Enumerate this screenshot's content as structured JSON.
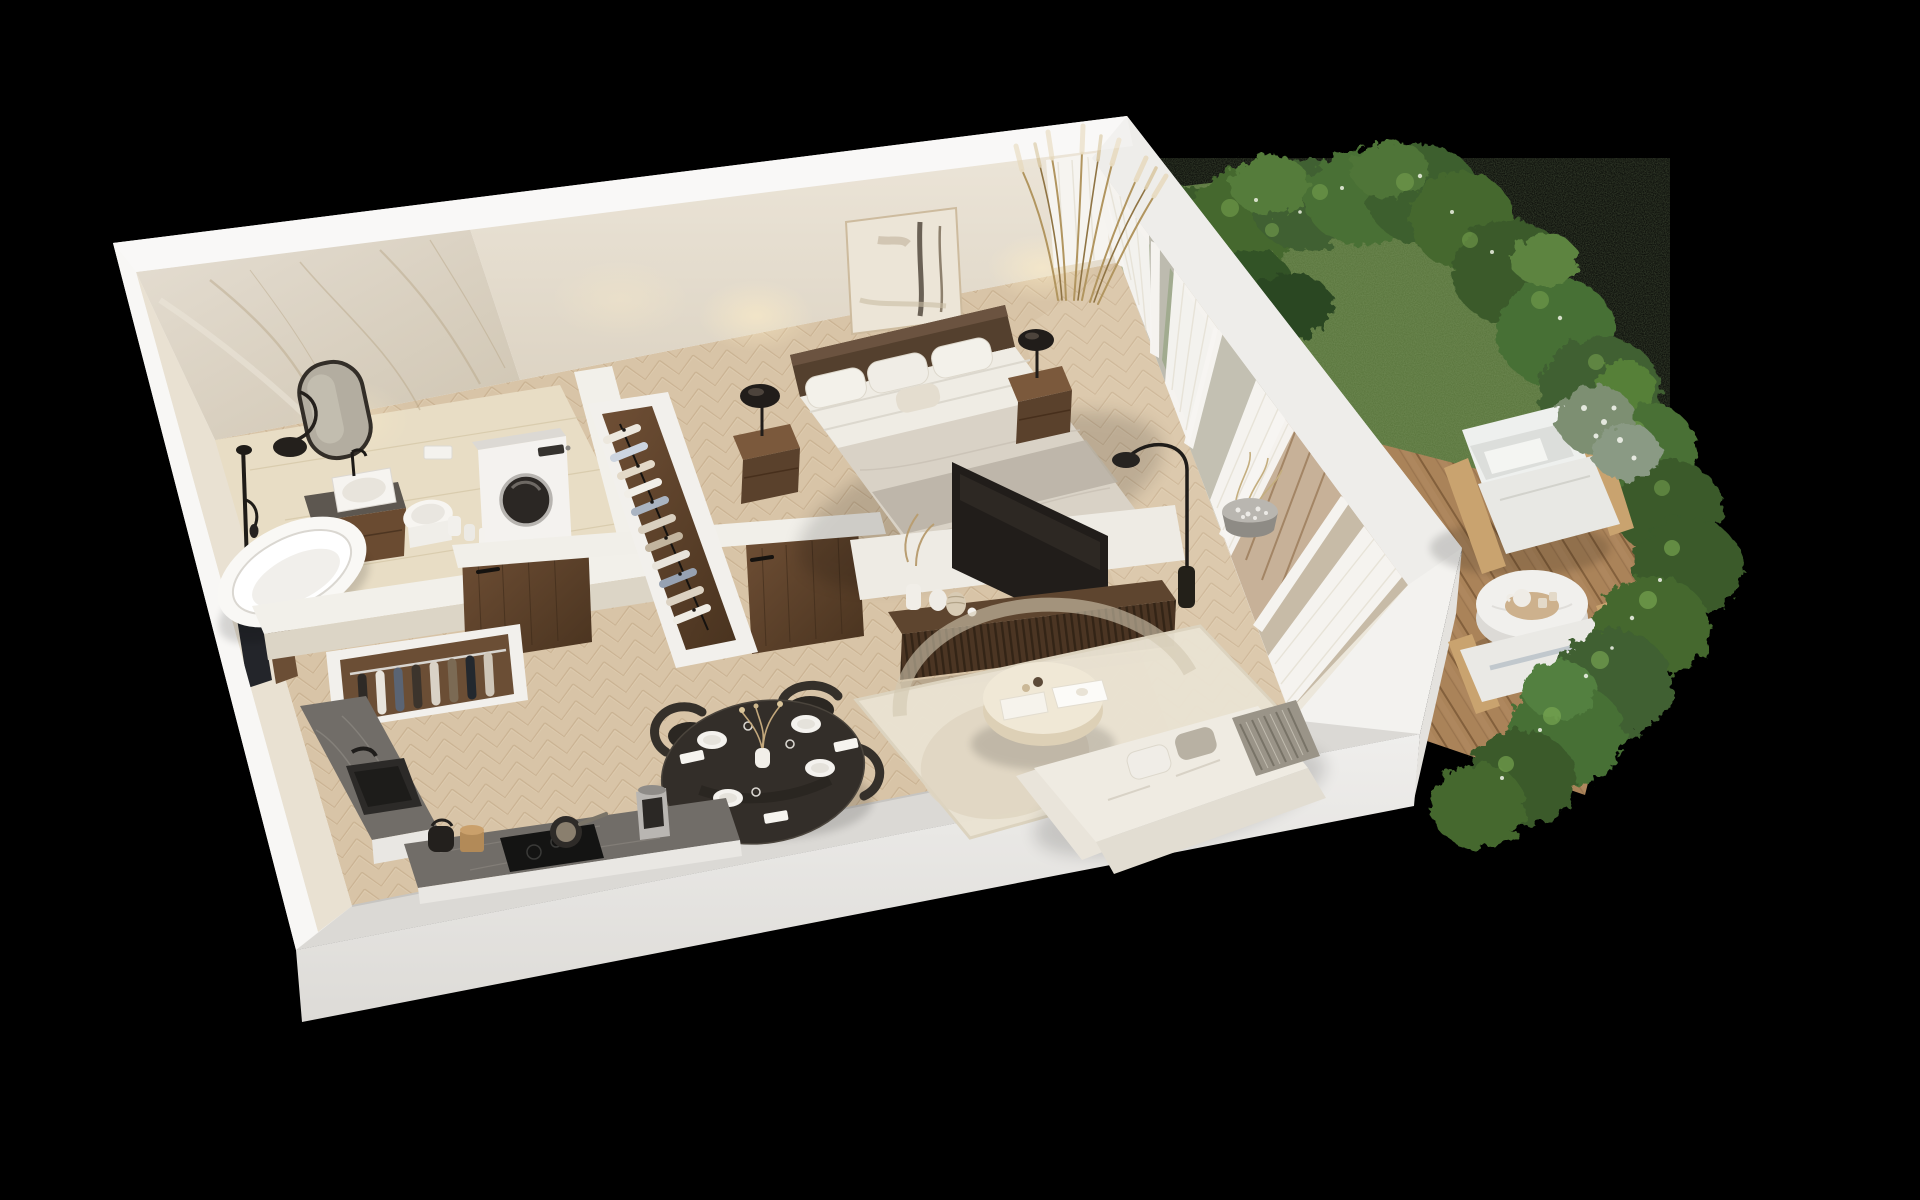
{
  "scene": {
    "type": "isometric-3d-floor-plan-render",
    "background": "#000000",
    "apartment": {
      "rooms": [
        {
          "name": "bathroom",
          "items": [
            "marble-feature-wall",
            "oval-mirror",
            "black-shower-set",
            "wall-lamp",
            "wood-vanity",
            "vessel-sink",
            "wall-hung-toilet",
            "flush-plate",
            "washing-machine",
            "freestanding-bathtub",
            "toiletry-canisters"
          ]
        },
        {
          "name": "bedroom",
          "items": [
            "abstract-artwork",
            "double-bed",
            "headboard",
            "pillows",
            "greige-duvet",
            "nightstand-left",
            "nightstand-right",
            "dome-table-lamps",
            "open-wardrobe-with-clothes"
          ]
        },
        {
          "name": "living-room",
          "items": [
            "wall-mounted-tv",
            "slatted-media-console",
            "decor-vases",
            "dried-plant",
            "arc-floor-lamp",
            "area-rug",
            "round-coffee-table",
            "white-sofa",
            "striped-throw",
            "cushions"
          ]
        },
        {
          "name": "dining-area",
          "items": [
            "round-black-table",
            "four-black-chairs",
            "place-settings",
            "wine-glasses",
            "napkins",
            "dried-flower-vase"
          ]
        },
        {
          "name": "kitchen",
          "items": [
            "l-shaped-stone-counter",
            "black-sink",
            "black-faucet",
            "induction-hob",
            "frying-pan",
            "coffee-machine",
            "kettle",
            "wooden-canister"
          ]
        },
        {
          "name": "hallway",
          "items": [
            "open-coat-closet",
            "entrance-door",
            "bathroom-door",
            "bedroom-door"
          ]
        }
      ],
      "glazing": "floor-to-ceiling window wall with sheer white curtains and sliding door to terrace"
    },
    "garden": {
      "items": [
        "lawn",
        "boxwood-hedge-border",
        "dark-pine-shrub",
        "tall-ornamental-grasses",
        "white-flowering-bush",
        "timber-deck",
        "outdoor-armchair-with-white-cushions",
        "outdoor-lounger-bench",
        "round-white-side-table",
        "tea-set-tray",
        "pebble-planter"
      ]
    },
    "palette": {
      "background": "#000000",
      "wall_white": "#f3f1ee",
      "wall_cream": "#e8e1d3",
      "marble": "#ddd5c7",
      "floor_oak": "#d9c7ab",
      "walnut_dark": "#5a4130",
      "textile_white": "#efece5",
      "textile_greige": "#cdc5b8",
      "counter_stone": "#6f6b66",
      "tv_black": "#211d1a",
      "grass_green": "#5b783d",
      "hedge_green": "#3f6030",
      "deck_wood": "#b1895e"
    }
  }
}
